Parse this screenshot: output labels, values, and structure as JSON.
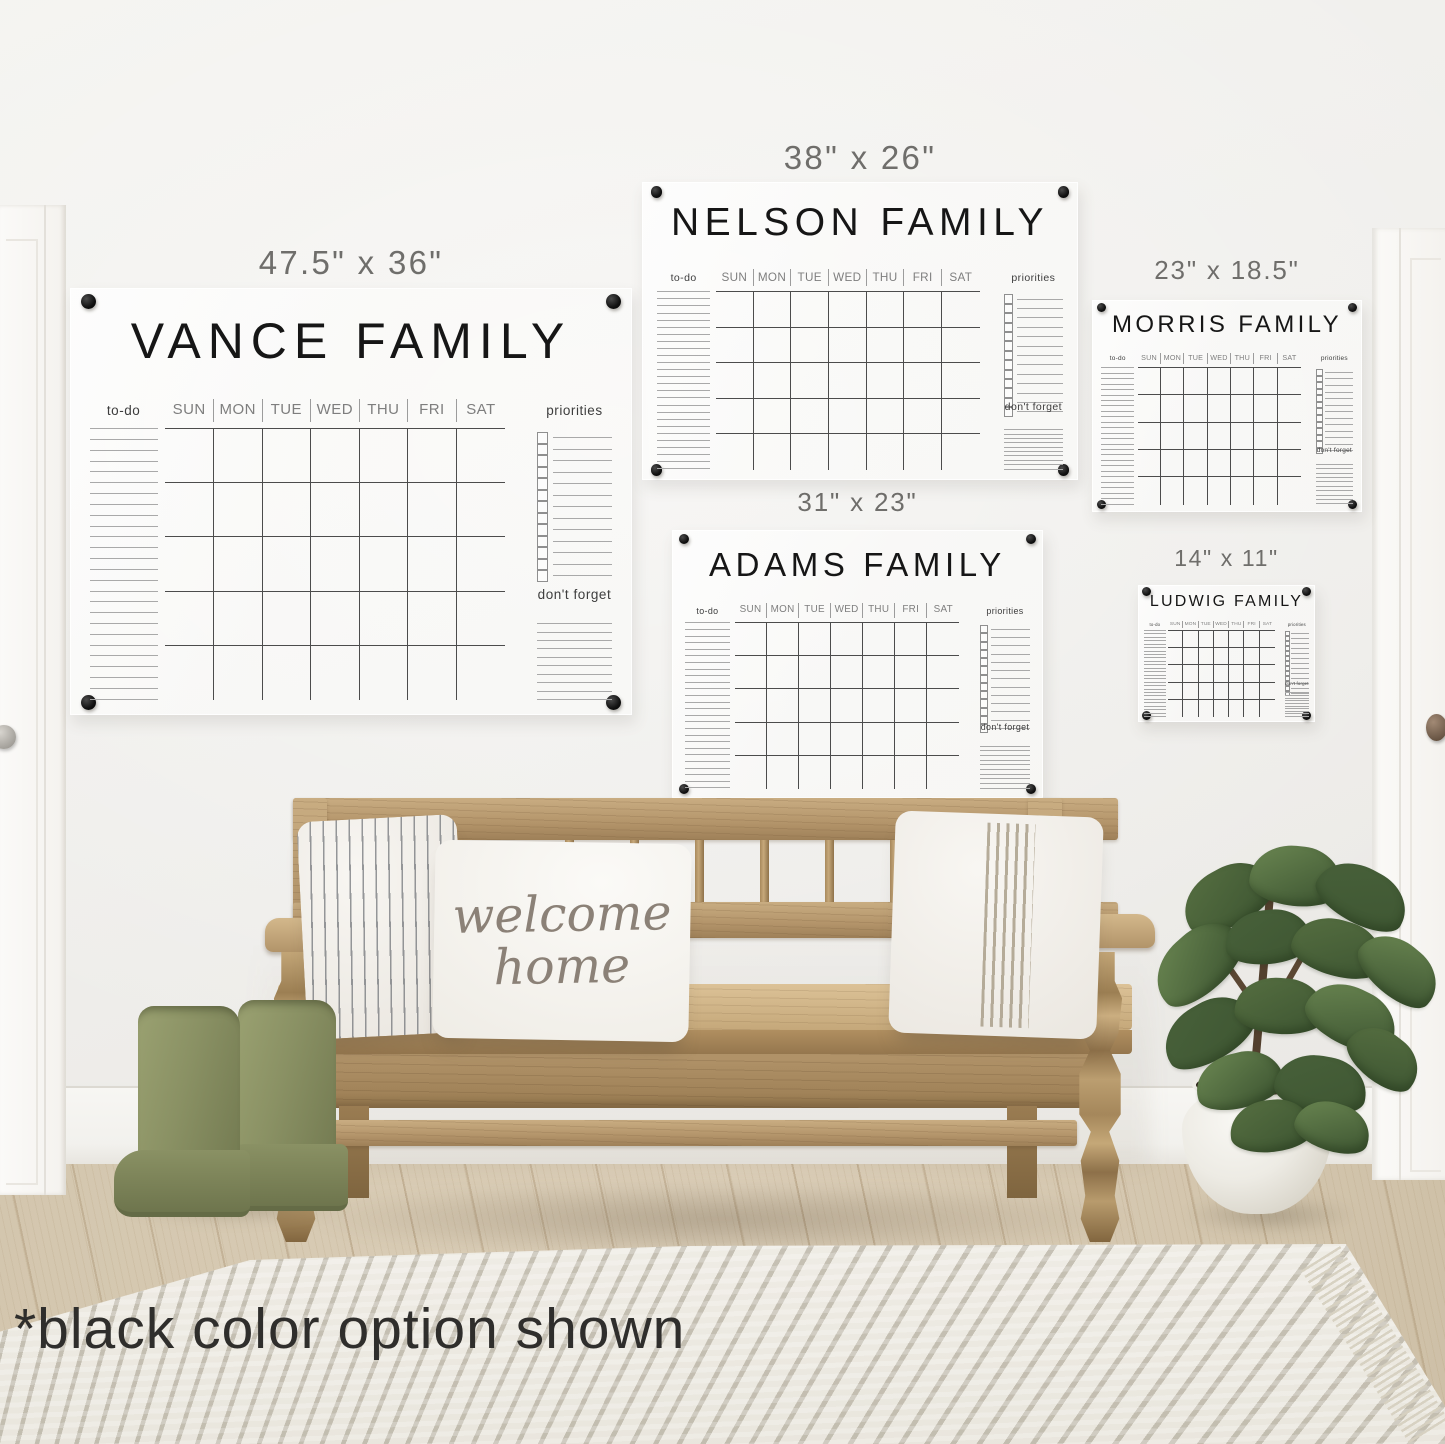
{
  "note_text": "*black color option shown",
  "pillow_text": {
    "line1": "welcome",
    "line2": "home"
  },
  "board_common": {
    "days": [
      "SUN",
      "MON",
      "TUE",
      "WED",
      "THU",
      "FRI",
      "SAT"
    ],
    "todo_label": "to-do",
    "priorities_label": "priorities",
    "dont_forget_label": "don't forget"
  },
  "boards": [
    {
      "name": "vance",
      "title": "VANCE FAMILY",
      "size_label": "47.5\" x 36\""
    },
    {
      "name": "nelson",
      "title": "NELSON FAMILY",
      "size_label": "38\" x 26\""
    },
    {
      "name": "morris",
      "title": "MORRIS FAMILY",
      "size_label": "23\" x 18.5\""
    },
    {
      "name": "adams",
      "title": "ADAMS FAMILY",
      "size_label": "31\" x 23\""
    },
    {
      "name": "ludwig",
      "title": "LUDWIG FAMILY",
      "size_label": "14\" x 11\""
    }
  ],
  "colors": {
    "marker_black": "#1b1b1b",
    "wood": "#b4966a",
    "boots_green": "#8a9064",
    "leaf_green": "#5d7a47",
    "wall": "#eeedea"
  }
}
